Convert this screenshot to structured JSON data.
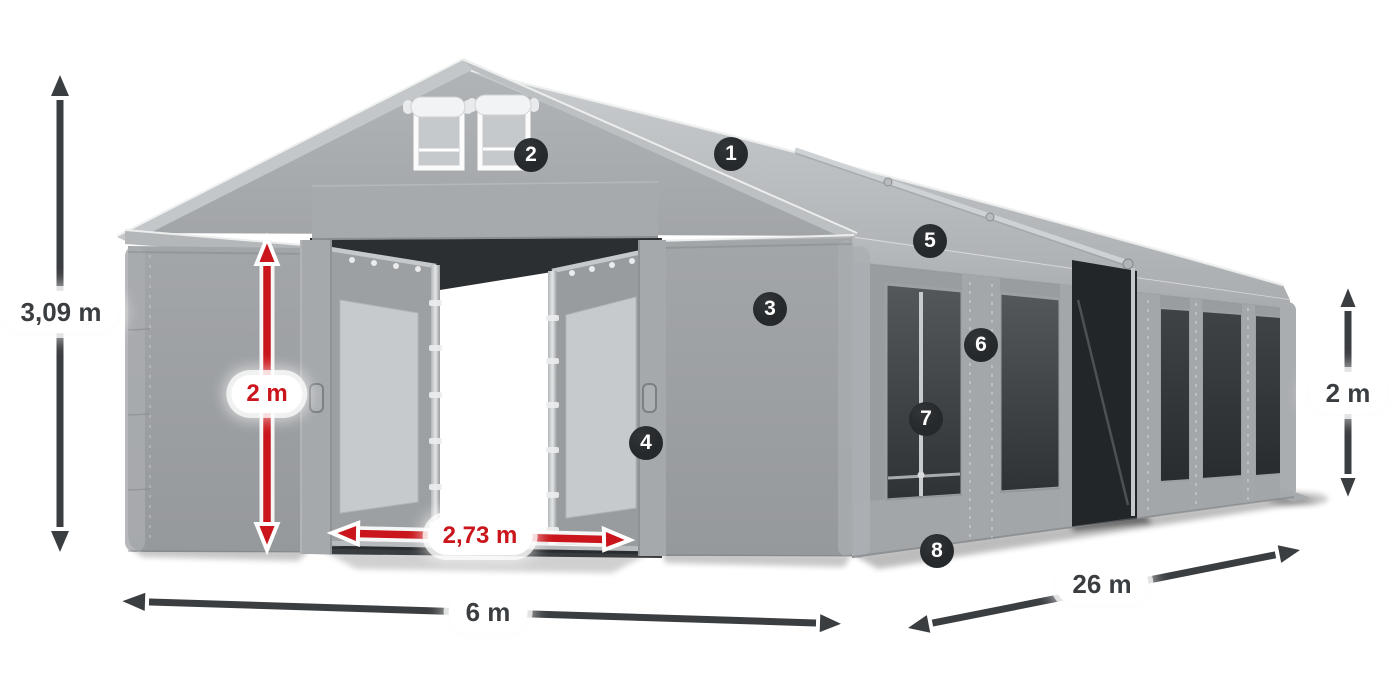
{
  "annotations": {
    "height_total": "3,09 m",
    "door_height": "2 m",
    "door_width": "2,73 m",
    "front_width": "6 m",
    "side_length": "26 m",
    "side_height": "2 m"
  },
  "markers": [
    "1",
    "2",
    "3",
    "4",
    "5",
    "6",
    "7",
    "8"
  ],
  "colors": {
    "accent_red": "#c9151b",
    "dimension_dark": "#3b3e41",
    "badge_bg": "#26292b",
    "badge_text": "#ffffff",
    "pill_bg": "#ffffff",
    "page_bg": "#ffffff"
  }
}
